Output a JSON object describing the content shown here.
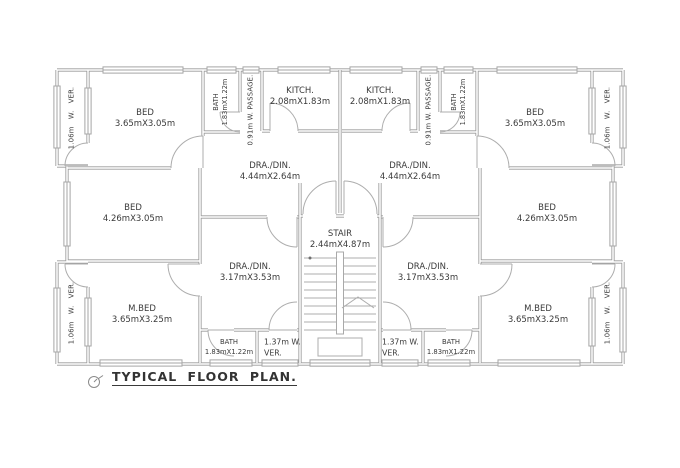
{
  "colors": {
    "background": "#ffffff",
    "wall_line": "#9b9b9b",
    "detail_line": "#adadad",
    "text": "#3a3a3a"
  },
  "title": {
    "text": "TYPICAL FLOOR PLAN."
  },
  "stair": {
    "name": "STAIR",
    "size": "2.44mX4.87m"
  },
  "left_unit": {
    "bed_top": {
      "name": "BED",
      "size": "3.65mX3.05m"
    },
    "bath_top": {
      "name": "BATH",
      "size": "1.83mX1.22m"
    },
    "passage": {
      "name": "0.91m W. PASSAGE."
    },
    "kitchen": {
      "name": "KITCH.",
      "size": "2.08mX1.83m"
    },
    "drawing_dining_upper": {
      "name": "DRA./DIN.",
      "size": "4.44mX2.64m"
    },
    "bed_middle": {
      "name": "BED",
      "size": "4.26mX3.05m"
    },
    "drawing_dining_lower": {
      "name": "DRA./DIN.",
      "size": "3.17mX3.53m"
    },
    "master_bed": {
      "name": "M.BED",
      "size": "3.65mX3.25m"
    },
    "bath_bottom": {
      "name": "BATH",
      "size": "1.83mX1.22m"
    },
    "veranda_side_top": {
      "name": "1.06m W. VER."
    },
    "veranda_side_bottom": {
      "name": "1.06m W. VER."
    },
    "veranda_stair": {
      "line1": "1.37m W.",
      "line2": "VER."
    }
  },
  "right_unit": {
    "bed_top": {
      "name": "BED",
      "size": "3.65mX3.05m"
    },
    "bath_top": {
      "name": "BATH",
      "size": "1.83mX1.22m"
    },
    "passage": {
      "name": "0.91m W. PASSAGE."
    },
    "kitchen": {
      "name": "KITCH.",
      "size": "2.08mX1.83m"
    },
    "drawing_dining_upper": {
      "name": "DRA./DIN.",
      "size": "4.44mX2.64m"
    },
    "bed_middle": {
      "name": "BED",
      "size": "4.26mX3.05m"
    },
    "drawing_dining_lower": {
      "name": "DRA./DIN.",
      "size": "3.17mX3.53m"
    },
    "master_bed": {
      "name": "M.BED",
      "size": "3.65mX3.25m"
    },
    "bath_bottom": {
      "name": "BATH",
      "size": "1.83mX1.22m"
    },
    "veranda_side_top": {
      "name": "1.06m W. VER."
    },
    "veranda_side_bottom": {
      "name": "1.06m W. VER."
    },
    "veranda_stair": {
      "line1": "1.37m W.",
      "line2": "VER."
    }
  }
}
